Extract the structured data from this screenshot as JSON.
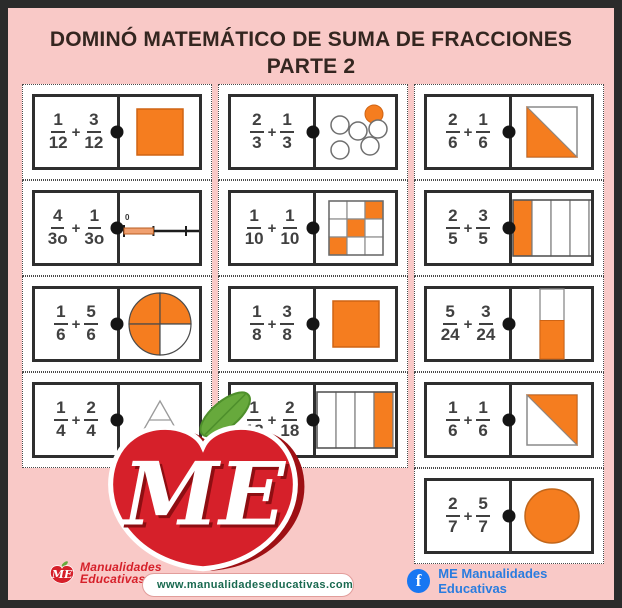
{
  "title": {
    "line1": "DOMINÓ MATEMÁTICO DE SUMA DE FRACCIONES",
    "line2": "PARTE 2"
  },
  "colors": {
    "background_pink": "#f9c9c7",
    "frame_border": "#2b2b2b",
    "title_text": "#342620",
    "orange_fill": "#f57d1f",
    "orange_border": "#cf6414",
    "brand_red": "#d6202a",
    "leaf_green": "#67a93c",
    "facebook_blue": "#1877f2",
    "url_text_green": "#19694f"
  },
  "dominoes": [
    {
      "row": 1,
      "col": 1,
      "f1": {
        "num": "1",
        "den": "12"
      },
      "op": "+",
      "f2": {
        "num": "3",
        "den": "12"
      },
      "visual": {
        "type": "square",
        "fill": "full"
      }
    },
    {
      "row": 1,
      "col": 2,
      "f1": {
        "num": "2",
        "den": "3"
      },
      "op": "+",
      "f2": {
        "num": "1",
        "den": "3"
      },
      "visual": {
        "type": "dots",
        "orange_count": 1,
        "white_count": 5
      }
    },
    {
      "row": 1,
      "col": 3,
      "f1": {
        "num": "2",
        "den": "6"
      },
      "op": "+",
      "f2": {
        "num": "1",
        "den": "6"
      },
      "visual": {
        "type": "square-diagonal",
        "filled": "lower-left"
      }
    },
    {
      "row": 2,
      "col": 1,
      "f1": {
        "num": "4",
        "den": "3o"
      },
      "op": "+",
      "f2": {
        "num": "1",
        "den": "3o"
      },
      "visual": {
        "type": "number-line",
        "labels": [
          "0",
          "1"
        ],
        "shaded_fraction": 0.32
      }
    },
    {
      "row": 2,
      "col": 2,
      "f1": {
        "num": "1",
        "den": "10"
      },
      "op": "+",
      "f2": {
        "num": "1",
        "den": "10"
      },
      "visual": {
        "type": "grid3",
        "orange_cells": [
          [
            0,
            2
          ],
          [
            1,
            1
          ],
          [
            2,
            0
          ]
        ]
      }
    },
    {
      "row": 2,
      "col": 3,
      "f1": {
        "num": "2",
        "den": "5"
      },
      "op": "+",
      "f2": {
        "num": "3",
        "den": "5"
      },
      "visual": {
        "type": "bar",
        "segments": 5,
        "filled": [
          0
        ]
      }
    },
    {
      "row": 3,
      "col": 1,
      "f1": {
        "num": "1",
        "den": "6"
      },
      "op": "+",
      "f2": {
        "num": "5",
        "den": "6"
      },
      "visual": {
        "type": "circle-quarters",
        "filled": [
          "tl",
          "tr",
          "bl"
        ]
      }
    },
    {
      "row": 3,
      "col": 2,
      "f1": {
        "num": "1",
        "den": "8"
      },
      "op": "+",
      "f2": {
        "num": "3",
        "den": "8"
      },
      "visual": {
        "type": "square",
        "fill": "full"
      }
    },
    {
      "row": 3,
      "col": 3,
      "f1": {
        "num": "5",
        "den": "24"
      },
      "op": "+",
      "f2": {
        "num": "3",
        "den": "24"
      },
      "visual": {
        "type": "vbar",
        "fill_from_bottom": 0.55
      }
    },
    {
      "row": 4,
      "col": 1,
      "f1": {
        "num": "1",
        "den": "4"
      },
      "op": "+",
      "f2": {
        "num": "2",
        "den": "4"
      },
      "visual": {
        "type": "triangle-outline"
      }
    },
    {
      "row": 4,
      "col": 2,
      "f1": {
        "num": "1",
        "den": "18"
      },
      "op": "+",
      "f2": {
        "num": "2",
        "den": "18"
      },
      "visual": {
        "type": "bar",
        "segments": 6,
        "filled": [
          3
        ]
      }
    },
    {
      "row": 4,
      "col": 3,
      "f1": {
        "num": "1",
        "den": "6"
      },
      "op": "+",
      "f2": {
        "num": "1",
        "den": "6"
      },
      "visual": {
        "type": "square-diagonal",
        "filled": "upper-right"
      }
    },
    {
      "row": 5,
      "col": 3,
      "f1": {
        "num": "2",
        "den": "7"
      },
      "op": "+",
      "f2": {
        "num": "5",
        "den": "7"
      },
      "visual": {
        "type": "circle",
        "fill": "full"
      }
    }
  ],
  "apple_logo": {
    "monogram": "ME"
  },
  "footer": {
    "brand": {
      "logo_text": "ME",
      "line1": "Manualidades",
      "line2": "Educativas"
    },
    "url_bar": {
      "url": "www.manualidadeseducativas.com"
    },
    "facebook": {
      "icon_letter": "f",
      "label": "ME Manualidades Educativas"
    }
  }
}
